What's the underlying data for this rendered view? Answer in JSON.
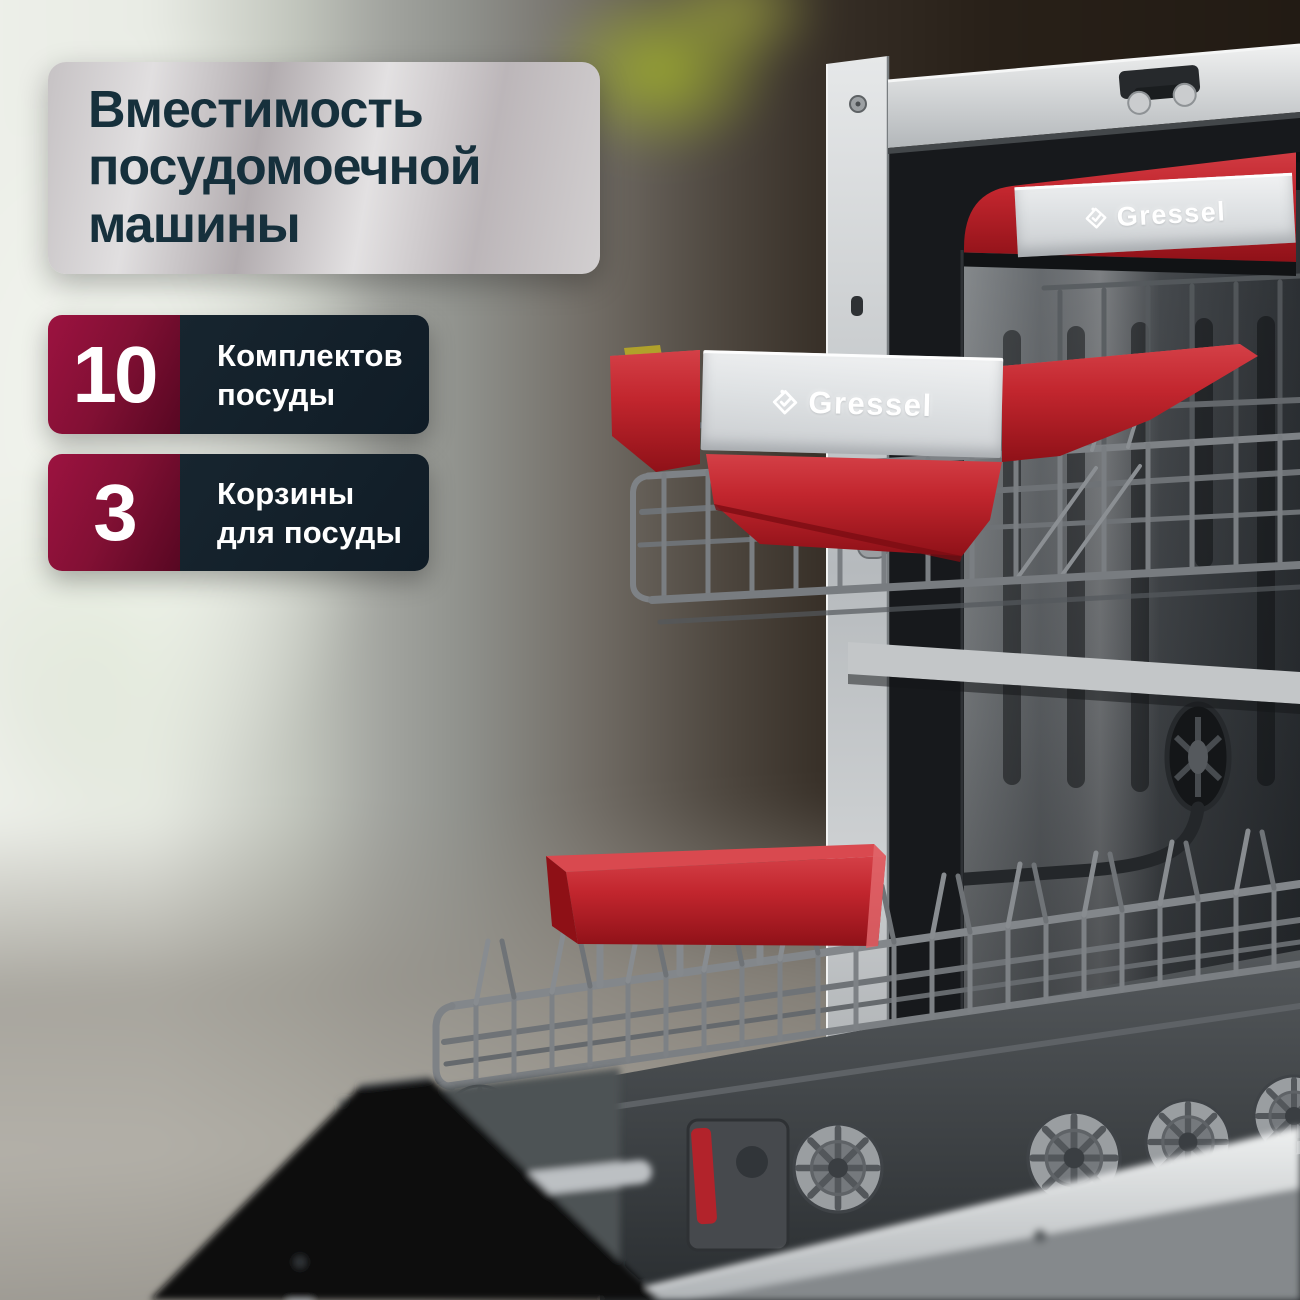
{
  "brand": {
    "name": "Gressel"
  },
  "title": {
    "text": "Вместимость посудомоечной машины"
  },
  "stats": [
    {
      "value": "10",
      "label_line1": "Комплектов",
      "label_line2": "посуды"
    },
    {
      "value": "3",
      "label_line1": "Корзины",
      "label_line2": "для посуды"
    }
  ],
  "colors": {
    "badge_crimson_light": "#9c1240",
    "badge_crimson_dark": "#570722",
    "badge_navy": "#111f2b",
    "title_text": "#16303c",
    "title_card_silver": "#d6d3d5",
    "basket_red": "#c2262e",
    "steel_silver": "#c9cccd"
  }
}
